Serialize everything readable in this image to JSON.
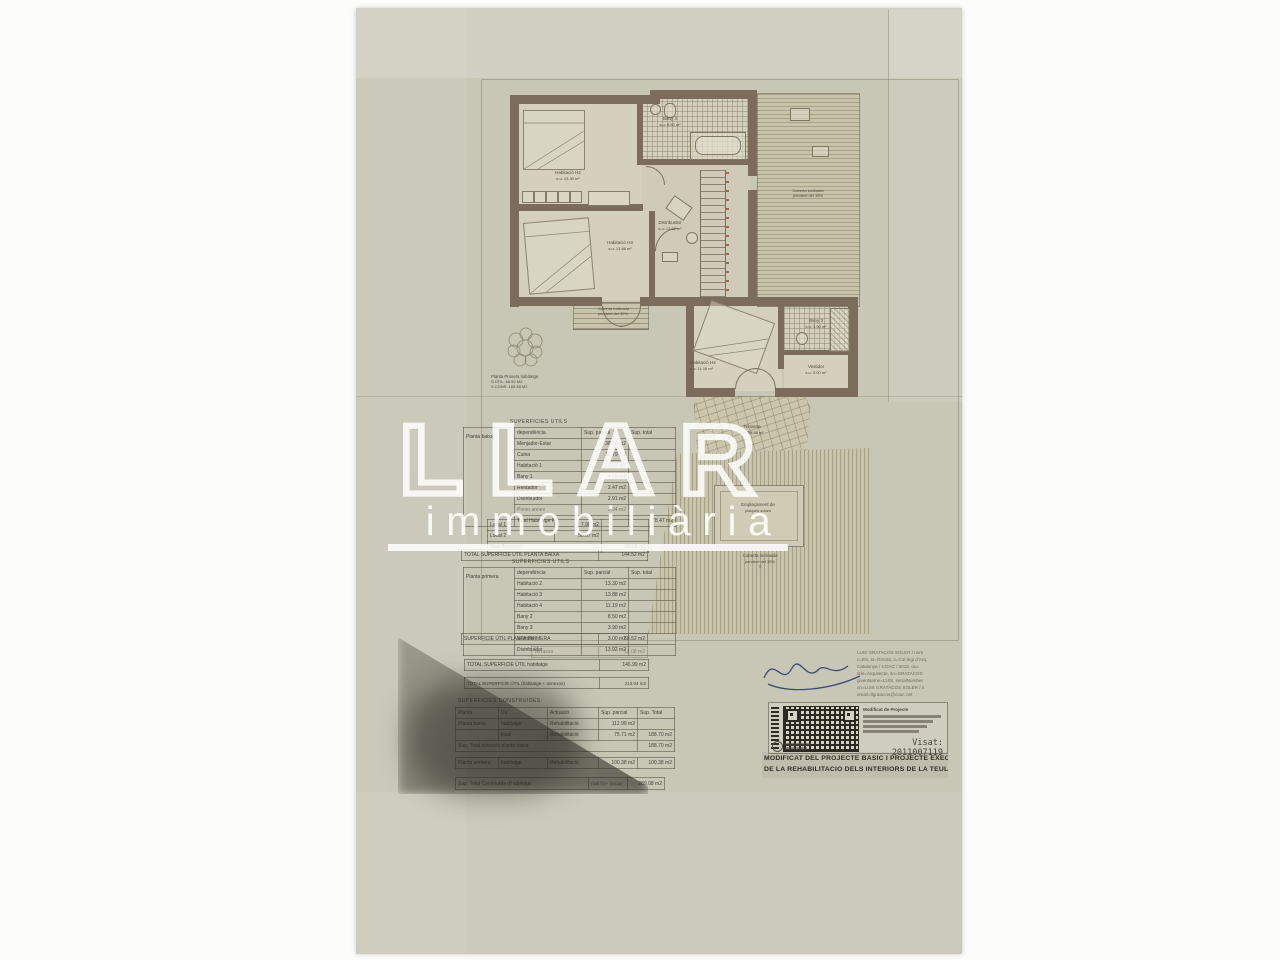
{
  "watermark": {
    "logo": "LLAR",
    "subtitle": "immobiliària"
  },
  "plan": {
    "rooms": {
      "h2": {
        "name": "Habitació H2",
        "area": "s.u: 13.30 m²"
      },
      "h3": {
        "name": "Habitació H3",
        "area": "s.u: 13.88 m²"
      },
      "distribuidor": {
        "name": "Distribuïdor",
        "area": "s.u: 13.92 m²"
      },
      "bany2": {
        "name": "Bany 2",
        "area": "s.u: 8.50 m²"
      },
      "h4": {
        "name": "Habitació H4",
        "area": "s.u: 11.19 m²"
      },
      "bany3": {
        "name": "Bany 3",
        "area": "s.u: 3.90 m²"
      },
      "vestidor": {
        "name": "Vestidor",
        "area": "s.u: 3.00 m²"
      },
      "terrassa": {
        "name": "Terrassa",
        "area": "s.u: 59.98 m²"
      }
    },
    "roof_label": {
      "line1": "Coberta inclinada",
      "line2": "pendent del 35%"
    },
    "solar_label": {
      "line1": "Emplaçament de",
      "line2": "plaques solars"
    },
    "summary": {
      "line1": "Planta Primera habitatge",
      "line2": "S.ÚTIL:  68.52 M2",
      "line3": "S.CONS: 169.48 M2"
    }
  },
  "tables": {
    "utils_pb": {
      "title": "SUPERFICIES UTILS",
      "group": "Planta baixa",
      "headers": [
        "dependència",
        "Sup. parcial",
        "Sup. total"
      ],
      "rows": [
        [
          "Menjador-Estar",
          "38.74 m2"
        ],
        [
          "Cuina",
          "13.79 m2"
        ],
        [
          "Habitació 1",
          "13.52 m2"
        ],
        [
          "Bany 1",
          "4.10 m2"
        ],
        [
          "Rentador",
          "2.47 m2"
        ],
        [
          "Distribuïdor",
          "2.91 m2"
        ],
        [
          "Porxo annex",
          "2.94 m2"
        ]
      ],
      "total_label": "Total Habitatge PB",
      "total_value": "78.47 m2",
      "annex_rows": [
        [
          "Local 1",
          "7.98 m2"
        ],
        [
          "Local 2",
          "58.07 m2"
        ]
      ],
      "annex_total_label": "Total Annexos",
      "annex_total_value": "66.05 m2",
      "grand_total_label": "TOTAL SUPERFICIE UTIL PLANTA BAIXA",
      "grand_total_value": "144.52 m2"
    },
    "utils_p1": {
      "title": "SUPERFICIES UTILS",
      "group": "Planta primera",
      "headers": [
        "dependència",
        "Sup. parcial",
        "Sup. total"
      ],
      "rows": [
        [
          "Habitació 2",
          "13.30 m2"
        ],
        [
          "Habitació 3",
          "13.88 m2"
        ],
        [
          "Habitació 4",
          "11.19 m2"
        ],
        [
          "Bany 2",
          "8.50 m2"
        ],
        [
          "Bany 3",
          "3.90 m2"
        ],
        [
          "Vestidor",
          "3.00 m2"
        ],
        [
          "Distribuïdor",
          "13.92 m2"
        ]
      ],
      "total_label": "SUPERFICIE ÚTIL PLANTA PRIMERA",
      "total_value": "68.52 m2",
      "terrassa_label": "Terrassa",
      "terrassa_value": "12.08 m2"
    },
    "totals": {
      "habitatge_label": "TOTAL SUPERFICIE ÚTIL habitatge",
      "habitatge_value": "146.99 m2",
      "conjunt_label": "TOTAL SUPERFICIE ÚTIL (habitatge + annexos)",
      "conjunt_value": "213.04 m2"
    },
    "construides": {
      "title": "SUPERFICIES CONSTRUIDES",
      "headers": [
        "Planta",
        "Ús",
        "Actuació",
        "Sup. parcial",
        "Sup. Total"
      ],
      "rows": [
        [
          "Planta baixa",
          "habitatge",
          "Rehabilitació",
          "112.99 m2",
          ""
        ],
        [
          "",
          "local",
          "Rehabilitació",
          "75.71 m2",
          "188.70 m2"
        ]
      ],
      "subtotal_label": "Sup. Total actuació planta baixa",
      "subtotal_value": "188.70 m2",
      "p1_row": [
        "Planta primera",
        "habitatge",
        "Rehabilitació",
        "100.38 m2",
        "100.38 m2"
      ],
      "total_label": "Sup. Total Construïda d'habitatge",
      "total_mid": "(188.70 + 100.38)",
      "total_value": "289.08 m2"
    }
  },
  "stamp": {
    "architect_lines": [
      "LUIS GRATACOS SOLER / num",
      "c=ES, st=Girona, o=Col·legi d'Arq.",
      "Catalunya / COAC / 0013, ou=",
      "title=Arquitecte, sn=GRATACOS",
      "givenName=LUIS, serialNumber",
      "cn=LUIS GRATACOS SOLER / n",
      "email=llgratacos@coac.net"
    ],
    "qr_heading": "Modificat de Projecte",
    "visat": "Visat: 2011007119",
    "title_line1": "MODIFICAT DEL PROJECTE BÀSIC I PROJECTE EXECUTIU",
    "title_line2": "DE LA REHABILITACIÓ DELS INTERIORS DE LA TEULERIA"
  },
  "colors": {
    "paper": "#c8c6b5",
    "wall": "#7b6c5c",
    "stair_red": "#a5503c",
    "signature_blue": "#2c3c72"
  }
}
